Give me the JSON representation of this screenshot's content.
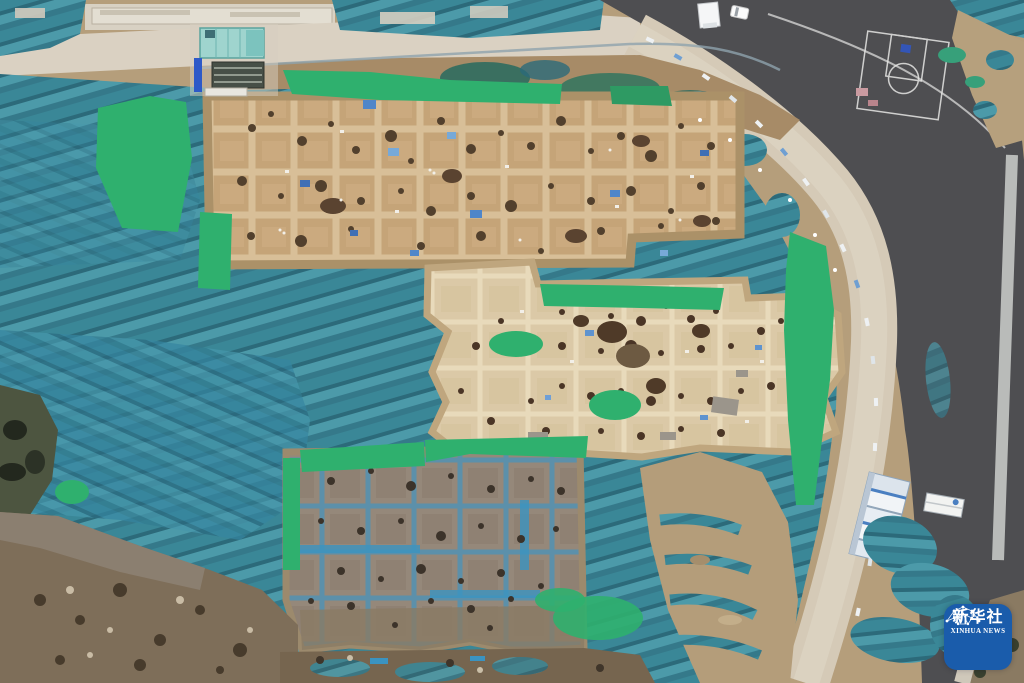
{
  "scene": {
    "description": "Aerial drone photograph of an archaeological excavation site: rectangular excavation trenches arranged in grids, surrounded by teal and bright-green protective netting, bordered by a curved dark asphalt road with painted basketball-court markings, a light service road, site offices and rows of white container cabins.",
    "regions": [
      "netting-cover",
      "north-excavation-grid",
      "central-excavation-area",
      "south-excavation-grid",
      "asphalt-road",
      "service-road",
      "top-access-road",
      "basketball-court-markings",
      "site-office",
      "scaffold-structure",
      "container-offices",
      "trucks",
      "soil-ground",
      "xinhua-watermark"
    ]
  },
  "watermark": {
    "title": "新华社",
    "subtitle": "XINHUA NEWS"
  },
  "palette": {
    "netting_teal": "#3a8797",
    "netting_light": "#4c9aa9",
    "netting_dark": "#2c6a7a",
    "bright_green": "#2fb06e",
    "earth_tan": "#b59e7b",
    "trench_tan": "#c5a478",
    "baulk_tan": "#d8bf98",
    "central_cream": "#dbc9a7",
    "south_gray": "#95887a",
    "south_blue": "#5591af",
    "asphalt": "#4e4e51",
    "road_light": "#d5cab7",
    "pavement": "#d8d1c3",
    "soil_dark": "#7e6e59",
    "pit_brown": "#52402d",
    "watermark_blue": "#1a5cab",
    "container_white": "#f1f4f7",
    "office_teal": "#9fd4ce",
    "court_line": "#e6e6e4"
  }
}
